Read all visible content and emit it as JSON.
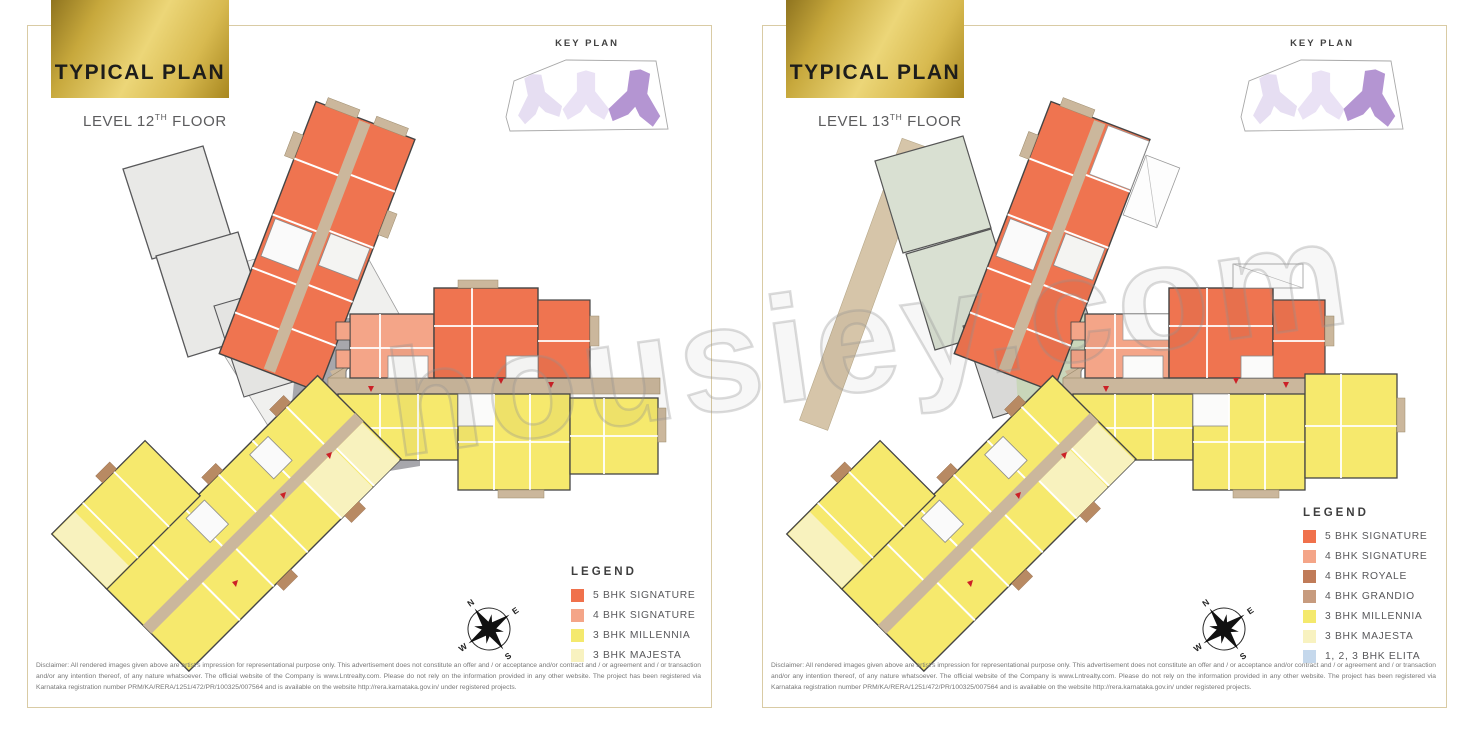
{
  "watermark": "housiey.com",
  "panels": [
    {
      "title": "TYPICAL PLAN",
      "level_prefix": "LEVEL 12",
      "level_sup": "TH",
      "level_suffix": " FLOOR",
      "key_plan_title": "KEY PLAN",
      "legend_title": "LEGEND",
      "legend": [
        {
          "label": "5 BHK SIGNATURE",
          "color": "#F0714C"
        },
        {
          "label": "4 BHK SIGNATURE",
          "color": "#F4A588"
        },
        {
          "label": "3 BHK MILLENNIA",
          "color": "#F4E96D"
        },
        {
          "label": "3 BHK MAJESTA",
          "color": "#F8F2C0"
        }
      ],
      "compass": {
        "n": "N",
        "e": "E",
        "w": "W",
        "s": "S"
      },
      "disclaimer": "Disclaimer: All rendered images given above are artist's impression for representational purpose only. This advertisement does not constitute an offer and / or acceptance and/or contract and / or agreement and / or transaction and/or any intention thereof, of any nature whatsoever. The official website of the Company is www.Lntrealty.com. Please do not rely on the information provided in any other website. The project has been registered via Karnataka registration number PRM/KA/RERA/1251/472/PR/100325/007564 and is available on the website http://rera.karnataka.gov.in/ under registered projects."
    },
    {
      "title": "TYPICAL PLAN",
      "level_prefix": "LEVEL 13",
      "level_sup": "TH",
      "level_suffix": " FLOOR",
      "key_plan_title": "KEY PLAN",
      "legend_title": "LEGEND",
      "legend": [
        {
          "label": "5 BHK SIGNATURE",
          "color": "#F0714C"
        },
        {
          "label": "4 BHK SIGNATURE",
          "color": "#F4A588"
        },
        {
          "label": "4 BHK ROYALE",
          "color": "#C07B58"
        },
        {
          "label": "4 BHK GRANDIO",
          "color": "#C79B7E"
        },
        {
          "label": "3 BHK MILLENNIA",
          "color": "#F4E96D"
        },
        {
          "label": "3 BHK MAJESTA",
          "color": "#F8F2C0"
        },
        {
          "label": "1, 2, 3 BHK ELITA",
          "color": "#C5D8EC"
        }
      ],
      "compass": {
        "n": "N",
        "e": "E",
        "w": "W",
        "s": "S"
      },
      "disclaimer": "Disclaimer: All rendered images given above are artist's impression for representational purpose only. This advertisement does not constitute an offer and / or acceptance and/or contract and / or agreement and / or transaction and/or any intention thereof, of any nature whatsoever. The official website of the Company is www.Lntrealty.com. Please do not rely on the information provided in any other website. The project has been registered via Karnataka registration number PRM/KA/RERA/1251/472/PR/100325/007564 and is available on the website http://rera.karnataka.gov.in/ under registered projects."
    }
  ]
}
